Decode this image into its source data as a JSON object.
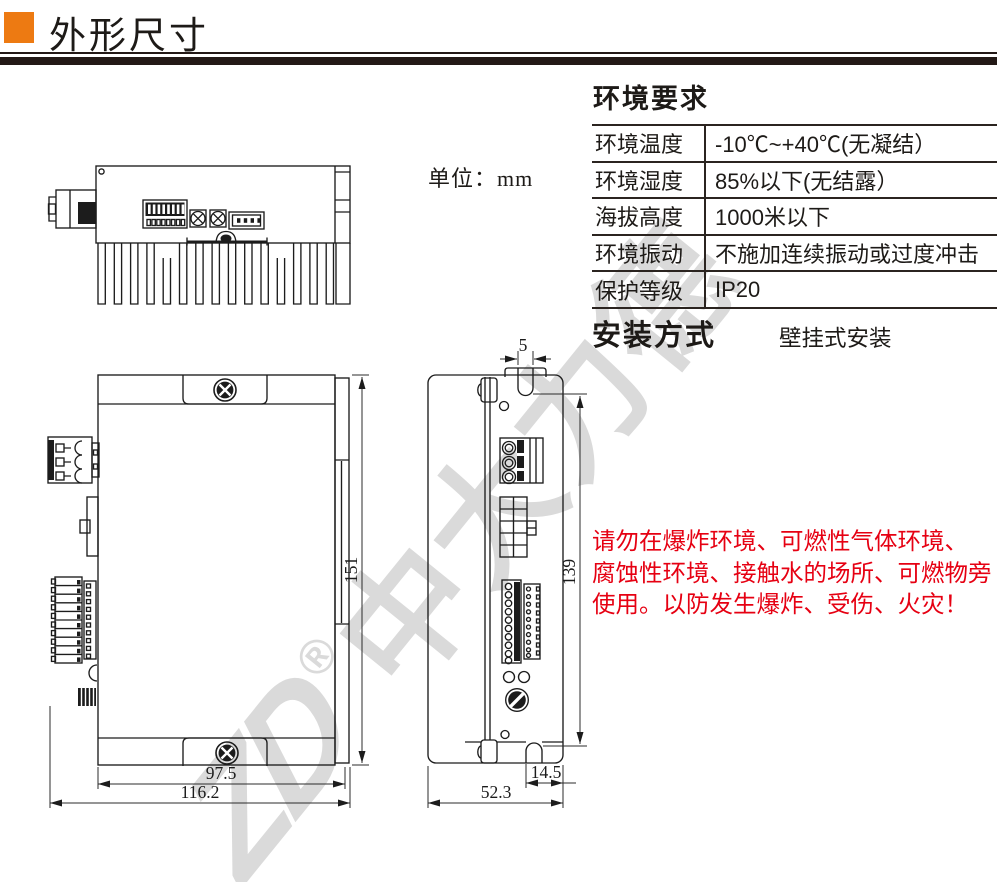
{
  "header": {
    "title": "外形尺寸"
  },
  "unit_label": "单位：mm",
  "env": {
    "title": "环境要求",
    "rows": [
      {
        "label": "环境温度",
        "value": "-10℃~+40℃(无凝结）"
      },
      {
        "label": "环境湿度",
        "value": "85%以下(无结露）"
      },
      {
        "label": "海拔高度",
        "value": "1000米以下"
      },
      {
        "label": "环境振动",
        "value": "不施加连续振动或过度冲击"
      },
      {
        "label": "保护等级",
        "value": "IP20"
      }
    ]
  },
  "install": {
    "title": "安装方式",
    "value": "壁挂式安装"
  },
  "warning": {
    "line1": "请勿在爆炸环境、可燃性气体环境、",
    "line2": "腐蚀性环境、接触水的场所、可燃物旁",
    "line3": "使用。以防发生爆炸、受伤、火灾！"
  },
  "dimensions": {
    "top_slot_width": "5",
    "front_height": "151",
    "side_height": "139",
    "front_width_inner": "97.5",
    "front_width_total": "116.2",
    "bottom_notch_offset": "14.5",
    "side_depth": "52.3"
  },
  "watermark": {
    "logo": "ZD",
    "reg": "®",
    "text": "中大力德"
  },
  "colors": {
    "accent_orange": "#ed7a12",
    "rule_dark": "#231916",
    "warning_red": "#e60012",
    "watermark_gray": "#dadada"
  }
}
